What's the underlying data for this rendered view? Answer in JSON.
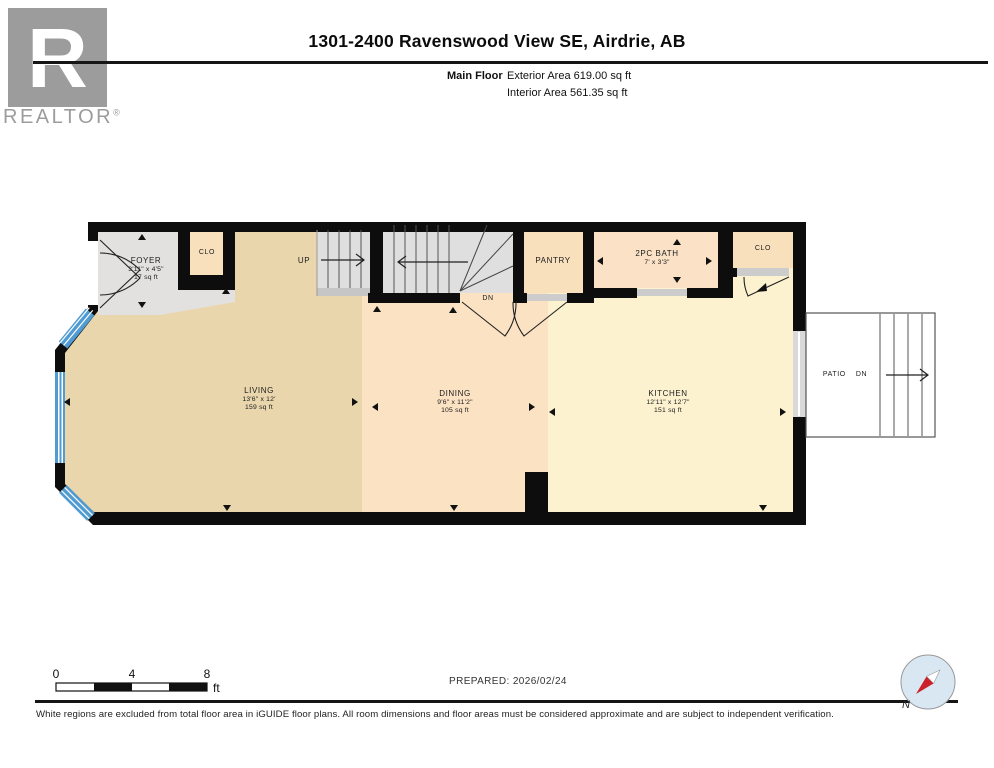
{
  "header": {
    "logo": {
      "letter": "R",
      "brand": "REALTOR",
      "registered": "®"
    },
    "title": "1301-2400 Ravenswood View SE, Airdrie, AB",
    "floor_label": "Main Floor",
    "exterior_area": "Exterior Area 619.00 sq ft",
    "interior_area": "Interior Area 561.35 sq ft"
  },
  "rooms": {
    "foyer": {
      "name": "FOYER",
      "dims": "3'11\" x 4'5\"",
      "area": "17 sq ft"
    },
    "closet_left": {
      "name": "CLO"
    },
    "stairs_up": {
      "name": "UP"
    },
    "stairs_down": {
      "name": "DN"
    },
    "pantry": {
      "name": "PANTRY"
    },
    "bath": {
      "name": "2PC BATH",
      "dims": "7' x 3'3\""
    },
    "closet_right": {
      "name": "CLO"
    },
    "living": {
      "name": "LIVING",
      "dims": "13'6\" x 12'",
      "area": "159 sq ft"
    },
    "dining": {
      "name": "DINING",
      "dims": "9'6\" x 11'2\"",
      "area": "105 sq ft"
    },
    "kitchen": {
      "name": "KITCHEN",
      "dims": "12'11\" x 12'7\"",
      "area": "151 sq ft"
    },
    "patio": {
      "name": "PATIO",
      "dn": "DN"
    }
  },
  "scale_bar": {
    "t0": "0",
    "t4": "4",
    "t8": "8",
    "unit": "ft"
  },
  "footer": {
    "prepared": "PREPARED: 2026/02/24",
    "disclaimer": "White regions are excluded from total floor area in iGUIDE floor plans. All room dimensions and floor areas must be considered approximate and are subject to independent verification.",
    "compass_north": "N"
  },
  "colors": {
    "wall": "#0d0d0d",
    "living": "#e9d6ac",
    "dining": "#fbe2c3",
    "kitchen": "#fdf2d0",
    "closet": "#f9e0bd",
    "bath": "#fbe2c6",
    "excluded_gray": "#e2e1df",
    "stair_gray": "#dfdfdf",
    "landing_gray": "#c6c6c6",
    "threshold_gray": "#cccccc",
    "window_blue": "#4f9bd2",
    "compass_red": "#cc2128",
    "compass_bg": "#d9e7f3"
  }
}
